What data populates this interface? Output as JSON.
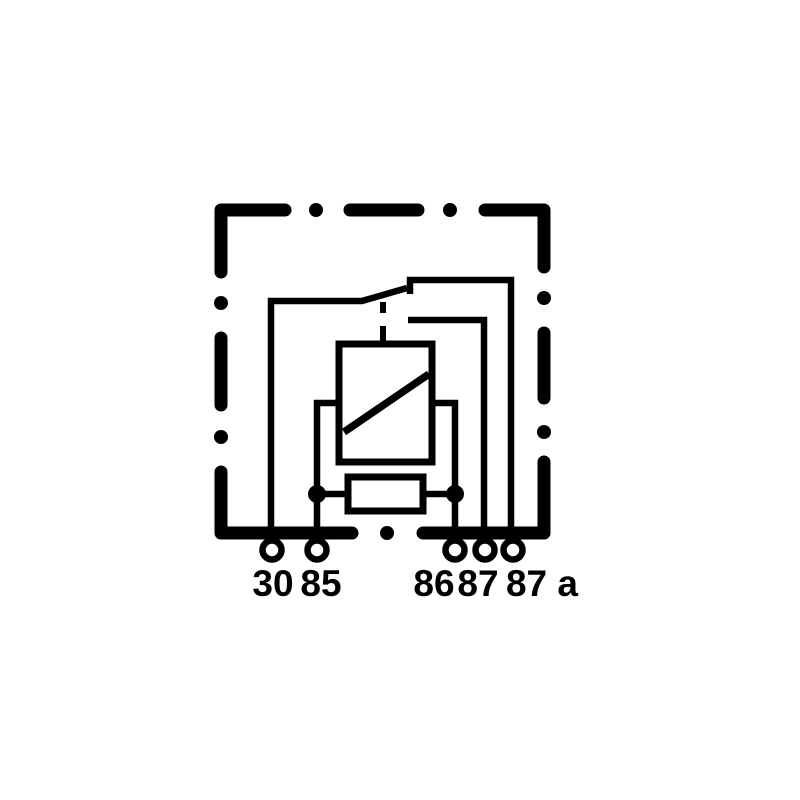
{
  "page": {
    "background_color": "#ffffff",
    "line_color": "#000000"
  },
  "diagram": {
    "kind": "relay wiring schematic",
    "terminals": [
      {
        "id": "30",
        "label": "30"
      },
      {
        "id": "85",
        "label": "85"
      },
      {
        "id": "86",
        "label": "86"
      },
      {
        "id": "87",
        "label": "87"
      },
      {
        "id": "87a",
        "label": "87 a"
      }
    ]
  }
}
